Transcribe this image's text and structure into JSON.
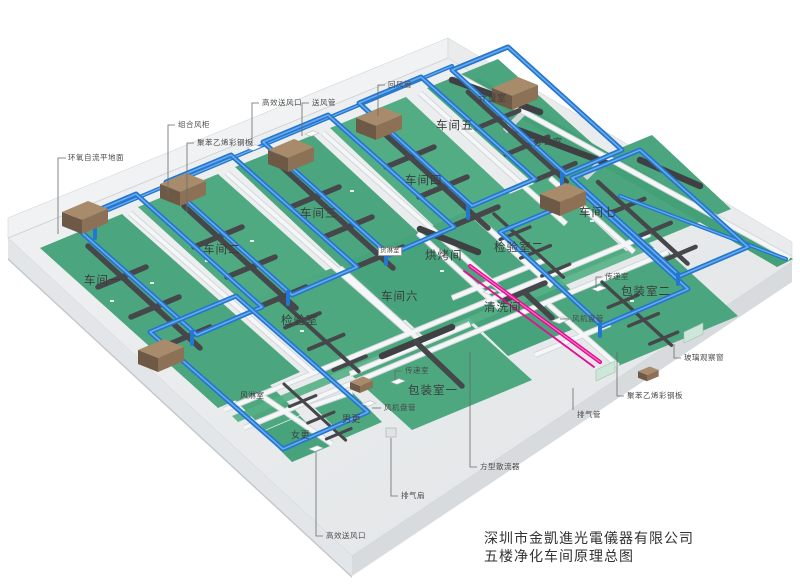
{
  "diagram": {
    "company": "深圳市金凱進光電儀器有限公司",
    "drawing_title": "五楼净化车间原理总图"
  },
  "rooms": {
    "w1": "车间一",
    "w2": "车间二",
    "w3": "车间三",
    "w4": "车间四",
    "w5": "车间五",
    "w6": "车间六",
    "w7": "车间七",
    "inspection1": "检验室",
    "inspection2": "检验室二",
    "baking": "烘烤间",
    "cleaning": "清洗间",
    "packing1": "包装室一",
    "packing2": "包装室二",
    "women_change": "女更",
    "men_change": "男更",
    "air_shower": "风淋室",
    "cargo_shower": "货淋室",
    "metering": "计量室",
    "office": "办公室"
  },
  "callouts": {
    "epoxy_floor": "环氧自流平地面",
    "ahu": "组合风柜",
    "panel_top": "聚苯乙烯彩钢板",
    "hepa_top": "高效送风口",
    "supply_duct": "送风管",
    "return_duct": "回风管",
    "pass_box1": "传递室",
    "fcu1": "风机盘管",
    "pass_box2": "传递室",
    "fcu2": "风机盘管",
    "exhaust_duct": "排气管",
    "glass_window": "玻璃观察窗",
    "panel_right": "聚苯乙烯彩钢板",
    "square_diffuser": "方型散流器",
    "exhaust_fan": "排气扇",
    "hepa_bottom": "高效送风口"
  },
  "colors": {
    "supply_duct_blue": "#2277d2",
    "extract_duct_dark": "#46474a",
    "floor_green": "#4ba57e",
    "exhaust_pink": "#e60d93",
    "ahu_brown": "#8d7156"
  }
}
